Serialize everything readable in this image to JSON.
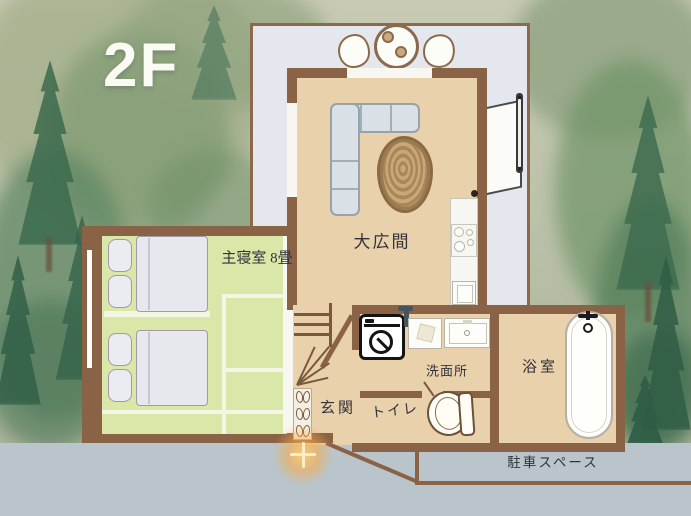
{
  "floor_label": "2F",
  "rooms": {
    "living": {
      "label": "大広間"
    },
    "bedroom": {
      "label": "主寝室 8畳"
    },
    "entrance": {
      "label": "玄関"
    },
    "washroom": {
      "label": "洗面所"
    },
    "toilet": {
      "label": "トイレ"
    },
    "bathroom": {
      "label": "浴室"
    },
    "parking": {
      "label": "駐車スペース"
    }
  },
  "colors": {
    "wall": "#8a6246",
    "deck": "#e4e8ee",
    "floor": "#e8d1ab",
    "tatami": "#d9e8a8",
    "road": "#b9c5ca",
    "glow": "#f5a94f",
    "label-ink": "#33323a"
  }
}
